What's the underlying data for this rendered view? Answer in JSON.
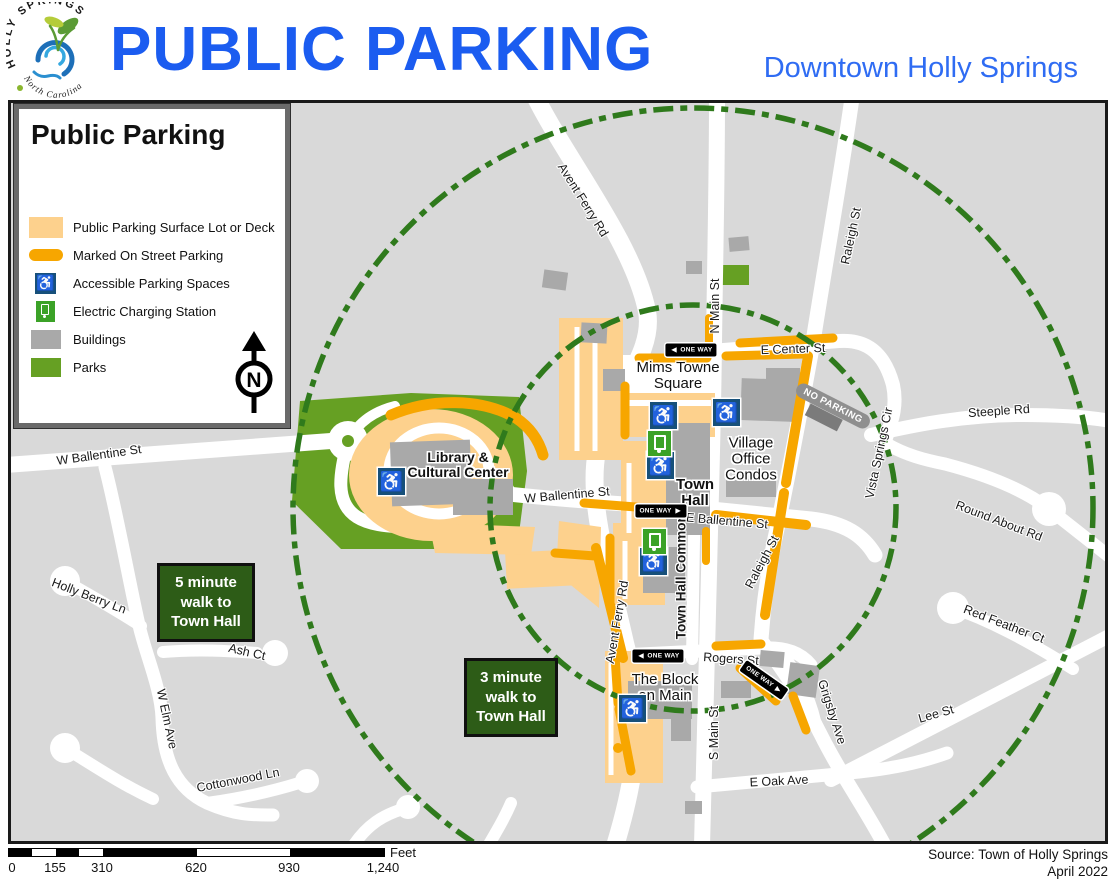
{
  "header": {
    "title": "PUBLIC PARKING",
    "subtitle": "Downtown Holly Springs",
    "logo_top": "HOLLY SPRINGS",
    "logo_bottom": "North Carolina"
  },
  "legend": {
    "title": "Public Parking",
    "items": [
      {
        "label": "Public Parking Surface Lot or Deck"
      },
      {
        "label": "Marked On Street Parking"
      },
      {
        "label": "Accessible Parking Spaces"
      },
      {
        "label": "Electric Charging Station"
      },
      {
        "label": "Buildings"
      },
      {
        "label": "Parks"
      }
    ],
    "north": "N"
  },
  "map": {
    "street_labels": [
      {
        "text": "Avent Ferry Rd"
      },
      {
        "text": "N Main St"
      },
      {
        "text": "Raleigh St"
      },
      {
        "text": "E Center St"
      },
      {
        "text": "Steeple Rd"
      },
      {
        "text": "Vista Springs Cir"
      },
      {
        "text": "W Ballentine St"
      },
      {
        "text": "W Ballentine St"
      },
      {
        "text": "E Ballentine St"
      },
      {
        "text": "Raleigh St"
      },
      {
        "text": "Round About Rd"
      },
      {
        "text": "Red Feather Ct"
      },
      {
        "text": "Lee St"
      },
      {
        "text": "Grigsby Ave"
      },
      {
        "text": "Rogers St"
      },
      {
        "text": "S Main St"
      },
      {
        "text": "E Oak Ave"
      },
      {
        "text": "Avent Ferry Rd"
      },
      {
        "text": "Town Hall Commons"
      },
      {
        "text": "Holly Berry Ln"
      },
      {
        "text": "Ash Ct"
      },
      {
        "text": "W Elm Ave"
      },
      {
        "text": "Cottonwood Ln"
      }
    ],
    "place_labels": [
      {
        "text": "Mims Towne\nSquare"
      },
      {
        "text": "Town\nHall"
      },
      {
        "text": "Village\nOffice\nCondos"
      },
      {
        "text": "Library &\nCultural Center"
      },
      {
        "text": "The Block\non Main"
      }
    ],
    "badges": [
      {
        "text": "5 minute\nwalk to\nTown Hall"
      },
      {
        "text": "3 minute\nwalk to\nTown Hall"
      }
    ],
    "signs": {
      "one_way": "ONE WAY",
      "no_parking": "NO PARKING"
    }
  },
  "scale_bar": {
    "ticks": [
      "0",
      "155",
      "310",
      "620",
      "930",
      "1,240"
    ],
    "unit": "Feet"
  },
  "footer": {
    "source": "Source: Town of Holly Springs",
    "date": "April 2022"
  },
  "colors": {
    "title_blue": "#1b5cf0",
    "subtitle_blue": "#2f6cf3",
    "map_background": "#d9d9d9",
    "road_white": "#ffffff",
    "building_gray": "#a9a9a9",
    "park_green": "#66a023",
    "parking_lot_peach": "#fdd18d",
    "street_parking_orange": "#f7a600",
    "walk_circle_green": "#2f7a1c",
    "badge_green": "#2d5c17",
    "accessible_blue": "#17507a",
    "ev_green": "#3ba227"
  }
}
